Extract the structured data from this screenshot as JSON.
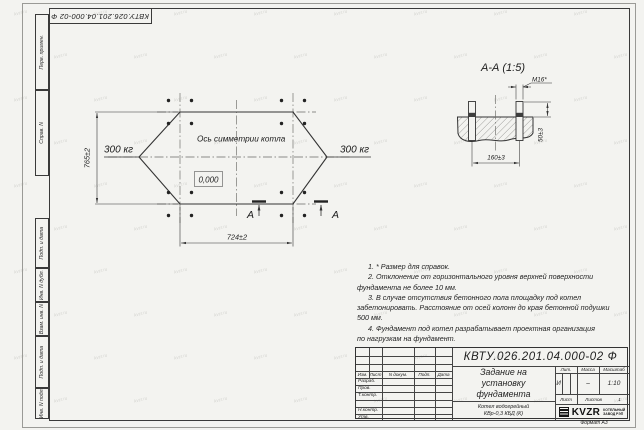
{
  "corner_stamp": {
    "doc_number": "КВТУ.026.201.04.000-02  Ф"
  },
  "margin_labels": {
    "perv_primen": "Перв. примен.",
    "sprav_n": "Справ. N",
    "podp_data_1": "Подп. и дата",
    "inv_dubl": "Инв. N дубл.",
    "vzam_inv": "Взам. инв. N",
    "podp_data_2": "Подп. и дата",
    "inv_podl": "Инв. N подл."
  },
  "plan": {
    "axis_label": "Ось симметрии котла",
    "load_left": "300 кг",
    "load_right": "300 кг",
    "level_mark": "0,000",
    "dim_height": "765±2",
    "dim_width": "724±2",
    "section_letter_left": "А",
    "section_letter_right": "А"
  },
  "section_view": {
    "title": "А-А  (1:5)",
    "dim_bolt": "М16*",
    "dim_protrusion": "50±3",
    "dim_spacing": "160±3"
  },
  "notes": {
    "lines": [
      {
        "text": "1.  * Размер для справок."
      },
      {
        "text": "2.  Отклонение от горизонтального уровня верхней поверхности"
      },
      {
        "text": "фундамента не более 10 мм."
      },
      {
        "text": "3.  В случае отсутствия бетонного пола площадку под котел"
      },
      {
        "text": "забетонировать. Расстояние от осей колонн до края бетонной подушки"
      },
      {
        "text": "500 мм."
      },
      {
        "text": "4.  Фундамент под котел разрабатывает проектная организация"
      },
      {
        "text": "по нагрузкам на фундамент."
      }
    ]
  },
  "title_block": {
    "doc_number": "КВТУ.026.201.04.000-02  Ф",
    "name_line1": "Задание на",
    "name_line2": "установку",
    "name_line3": "фундамента",
    "product_line1": "Котел водогрейный",
    "product_line2": "КВр-0,3  КБД  (К)",
    "col_izm": "Изм.",
    "col_list": "Лист",
    "col_dokum": "N докум.",
    "col_podp": "Подп.",
    "col_data": "Дата",
    "row_razrab": "Разраб.",
    "row_prov": "Пров.",
    "row_tkontr": "Т.контр.",
    "row_nkontr": "Н.контр.",
    "row_utv": "Утв.",
    "lit_label": "Лит.",
    "lit_value": "И",
    "mass_label": "Масса",
    "mass_value": "–",
    "scale_label": "Масштаб",
    "scale_value": "1:10",
    "sheet_label": "Лист",
    "sheets_label": "Листов",
    "sheets_value": "1",
    "logo_text": "KVZR",
    "company_line1": "КОТЕЛЬНЫЙ",
    "company_line2": "ЗАВОД РЭП",
    "format_label": "Формат А3"
  },
  "watermark": {
    "text": "kvzr.ru"
  }
}
